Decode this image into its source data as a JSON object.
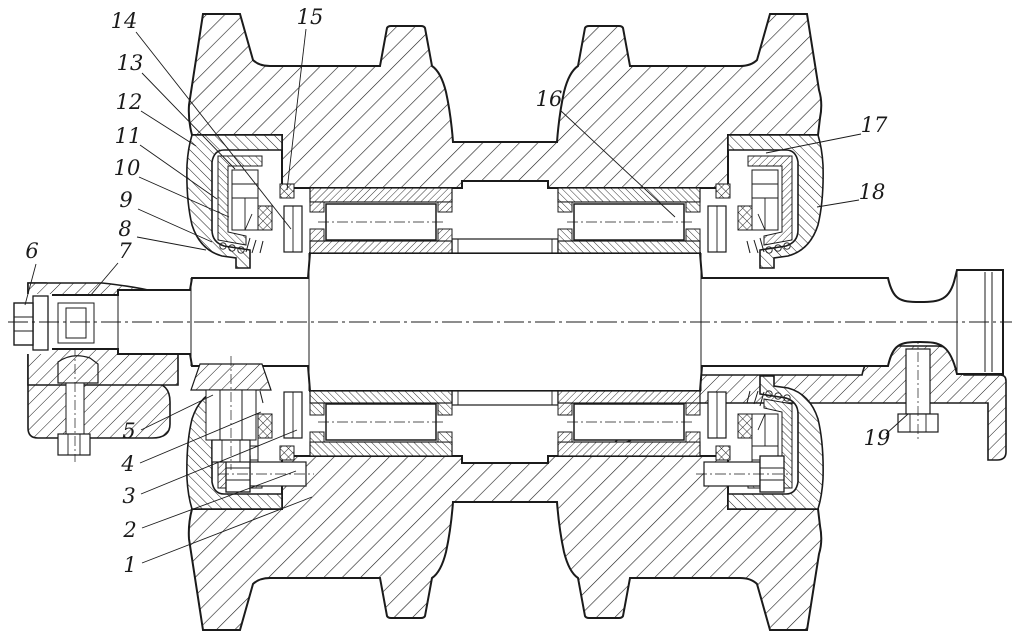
{
  "figure": {
    "callouts": [
      {
        "label": "1"
      },
      {
        "label": "2"
      },
      {
        "label": "3"
      },
      {
        "label": "4"
      },
      {
        "label": "5"
      },
      {
        "label": "6"
      },
      {
        "label": "7"
      },
      {
        "label": "8"
      },
      {
        "label": "9"
      },
      {
        "label": "10"
      },
      {
        "label": "11"
      },
      {
        "label": "12"
      },
      {
        "label": "13"
      },
      {
        "label": "14"
      },
      {
        "label": "15"
      },
      {
        "label": "16"
      },
      {
        "label": "17"
      },
      {
        "label": "18"
      },
      {
        "label": "19"
      }
    ]
  },
  "colors": {
    "ink": "#1b1b1b",
    "paper": "#ffffff"
  }
}
